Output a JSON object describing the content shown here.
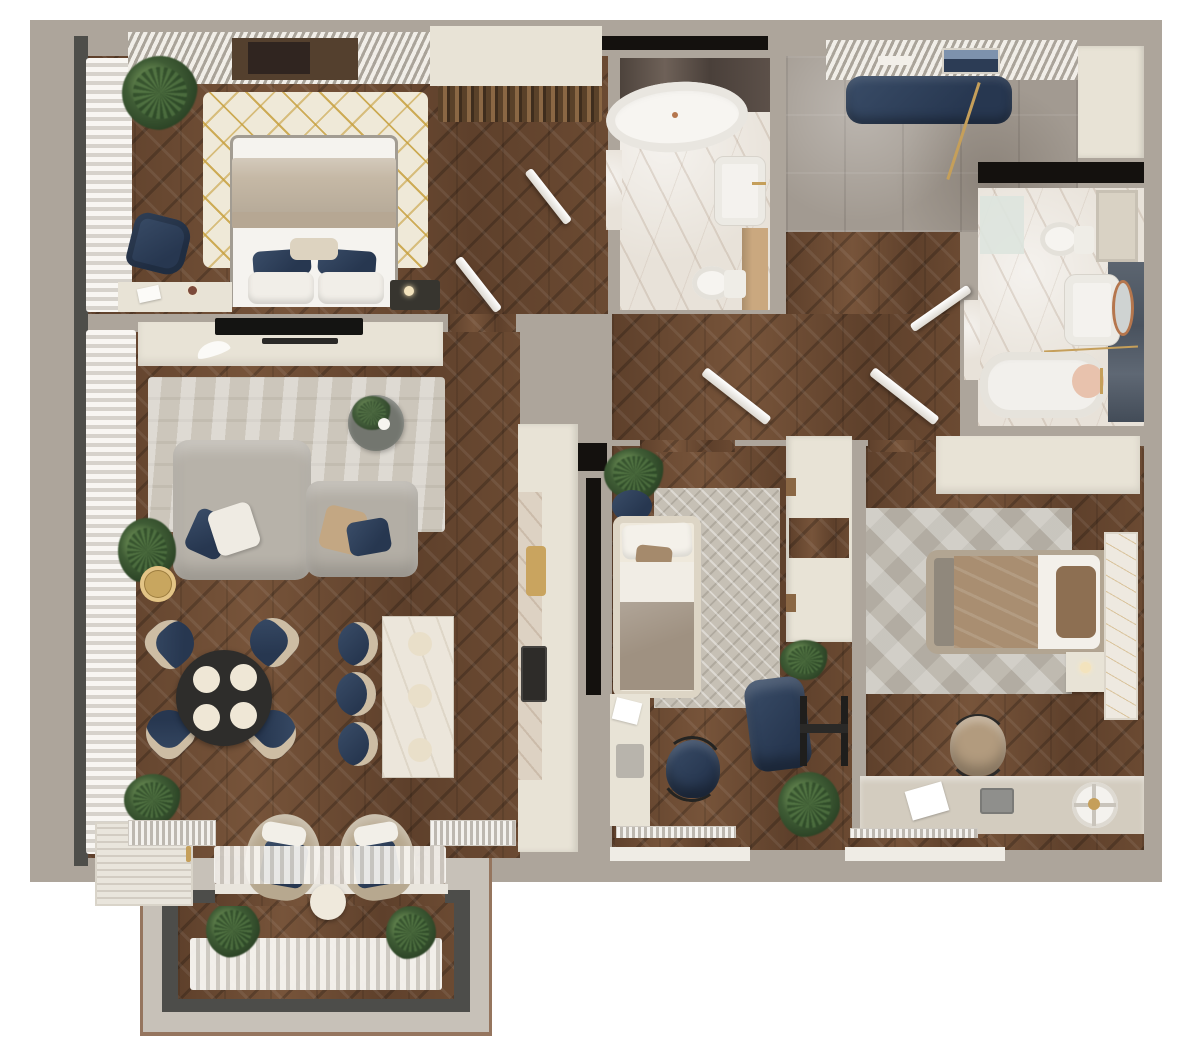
{
  "meta": {
    "title": "Apartment 3D floor plan (top-down render)",
    "view": "top-down interior render",
    "canvas": {
      "width": 1199,
      "height": 1042
    }
  },
  "palette": {
    "background": "#ffffff",
    "outer_wall": "#ada59b",
    "wood_floor": "#6b4a32",
    "white_marble": "#e8e2d9",
    "gray_tile": "#a29a91",
    "dark_window_frame": "#4e4e4a",
    "cream_furniture": "#e8e3d6",
    "navy_accent": "#31435c",
    "beige_textile": "#ab9379",
    "sofa_gray": "#b6b1a8",
    "gold_accent": "#c59f5a",
    "plant_green": "#3f5c35",
    "balcony_frame": "#4d4d4a",
    "balcony_trim": "#95755e"
  },
  "rooms": [
    {
      "id": "bedroom-1",
      "label": "Master bedroom",
      "furniture": [
        "double-bed",
        "gold-pattern-rug",
        "navy-armchair",
        "vanity-desk",
        "dark-nightstand",
        "plant",
        "sheer-curtains",
        "slatted-wardrobe"
      ]
    },
    {
      "id": "dressing-room",
      "label": "Dressing room",
      "furniture": [
        "top-cabinet",
        "clothes-rack",
        "open-doors"
      ]
    },
    {
      "id": "bathroom-1",
      "label": "Main bathroom",
      "furniture": [
        "freestanding-oval-tub",
        "washbasin",
        "toilet",
        "dark-marble-wall"
      ]
    },
    {
      "id": "entry-hall",
      "label": "Entry hall",
      "furniture": [
        "navy-bench",
        "slatted-shelf",
        "wall-picture",
        "coat-stand",
        "wardrobe"
      ]
    },
    {
      "id": "bathroom-2",
      "label": "Second bathroom",
      "furniture": [
        "bathtub",
        "washbasin",
        "round-mirror",
        "toilet",
        "wall-cabinet",
        "blue-tile-wall",
        "shower-mat"
      ]
    },
    {
      "id": "hallway",
      "label": "Hallway",
      "furniture": [
        "open-doors"
      ]
    },
    {
      "id": "living-room",
      "label": "Living room / kitchen / dining",
      "furniture": [
        "tv-console",
        "tv",
        "soundbar",
        "rug",
        "corner-sofa",
        "pillows",
        "round-coffee-table",
        "gold-side-table",
        "dining-table",
        "four-navy-chairs",
        "marble-island",
        "three-navy-stools",
        "two-lounge-armchairs",
        "white-sideboard",
        "radiators",
        "sheer-curtains",
        "plants"
      ]
    },
    {
      "id": "kitchen-strip",
      "label": "Kitchen counter",
      "furniture": [
        "counter",
        "marble-splash",
        "cutting-board",
        "cooktop"
      ]
    },
    {
      "id": "kids-room",
      "label": "Kids room / study",
      "furniture": [
        "sofa-bed",
        "herringbone-rug",
        "wardrobe",
        "navy-pouf",
        "easel",
        "desk",
        "navy-desk-chair",
        "plants",
        "radiator"
      ]
    },
    {
      "id": "bedroom-2",
      "label": "Second bedroom",
      "furniture": [
        "wardrobe",
        "triangle-rug",
        "single-bed",
        "nightstand",
        "wall-art-panel",
        "desk",
        "laptop",
        "desk-chair",
        "fan",
        "radiator"
      ]
    },
    {
      "id": "balcony",
      "label": "Balcony bay",
      "furniture": [
        "round-table",
        "plants",
        "sheer-curtains",
        "glazing-frame"
      ]
    }
  ]
}
